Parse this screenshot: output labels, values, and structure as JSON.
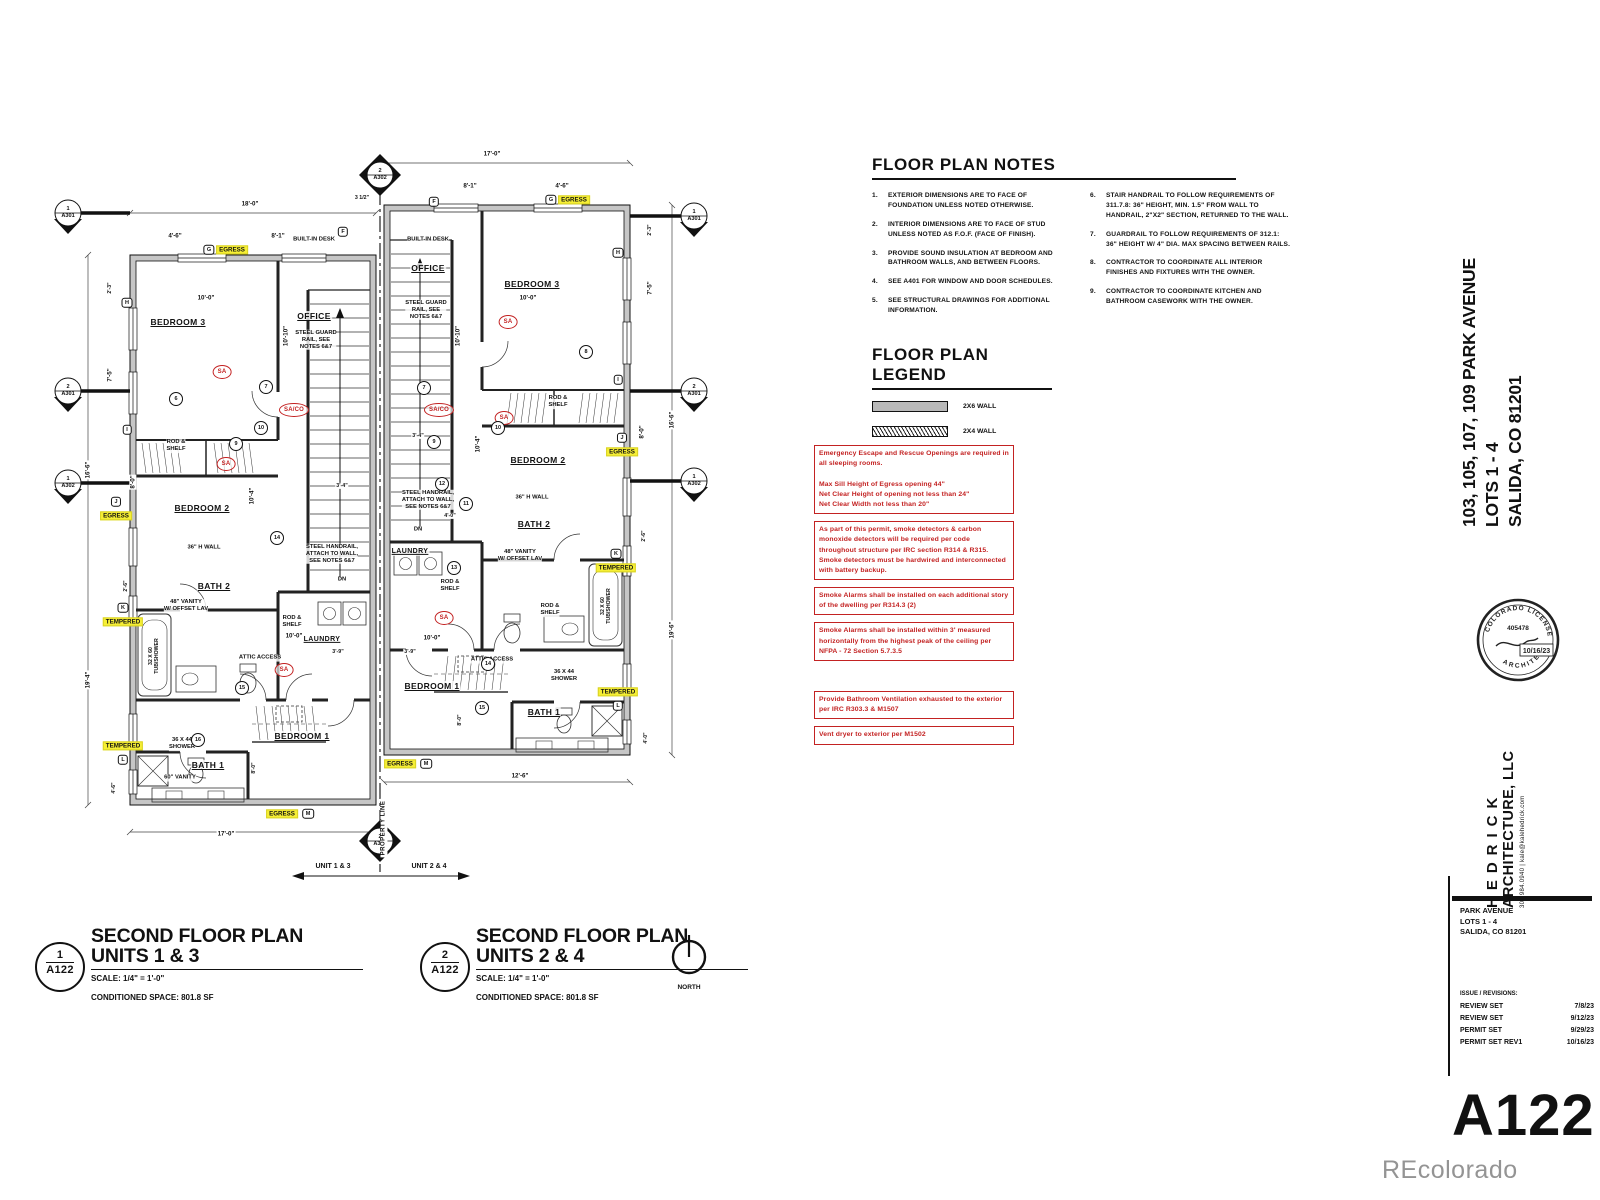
{
  "sheet": {
    "number": "A122",
    "watermark": "REcolorado"
  },
  "plan_notes": {
    "title": "FLOOR PLAN NOTES",
    "col1": [
      {
        "n": "1.",
        "t": "EXTERIOR DIMENSIONS ARE TO FACE OF FOUNDATION UNLESS NOTED OTHERWISE."
      },
      {
        "n": "2.",
        "t": "INTERIOR DIMENSIONS ARE TO FACE OF STUD UNLESS NOTED AS F.O.F. (FACE OF FINISH)."
      },
      {
        "n": "3.",
        "t": "PROVIDE SOUND INSULATION AT BEDROOM AND BATHROOM WALLS, AND BETWEEN FLOORS."
      },
      {
        "n": "4.",
        "t": "SEE A401 FOR WINDOW AND DOOR SCHEDULES."
      },
      {
        "n": "5.",
        "t": "SEE STRUCTURAL DRAWINGS FOR ADDITIONAL INFORMATION."
      }
    ],
    "col2": [
      {
        "n": "6.",
        "t": "STAIR HANDRAIL TO FOLLOW REQUIREMENTS OF 311.7.8: 36\" HEIGHT, MIN. 1.5\" FROM WALL TO HANDRAIL, 2\"X2\" SECTION, RETURNED TO THE WALL."
      },
      {
        "n": "7.",
        "t": "GUARDRAIL TO FOLLOW REQUIREMENTS OF 312.1: 36\" HEIGHT W/ 4\" DIA. MAX SPACING BETWEEN RAILS."
      },
      {
        "n": "8.",
        "t": "CONTRACTOR TO COORDINATE ALL INTERIOR FINISHES AND FIXTURES WITH THE OWNER."
      },
      {
        "n": "9.",
        "t": "CONTRACTOR TO COORDINATE KITCHEN AND BATHROOM CASEWORK WITH THE OWNER."
      }
    ]
  },
  "legend": {
    "title": "FLOOR PLAN LEGEND",
    "items": [
      {
        "label": "2X6  WALL",
        "style": "solid"
      },
      {
        "label": "2X4  WALL",
        "style": "hatched"
      }
    ]
  },
  "code_notes": [
    {
      "text": "Emergency Escape and Rescue Openings are required in all sleeping rooms.\n\nMax Sill Height of Egress opening 44\"\nNet Clear Height of opening not less than 24\"\nNet Clear Width not less than 20\""
    },
    {
      "text": "As part of this permit, smoke detectors & carbon monoxide detectors will be required per code throughout structure per IRC section R314 & R315. Smoke detectors must be hardwired and interconnected with battery backup."
    },
    {
      "text": "Smoke Alarms shall be installed on each additional story of the dwelling per R314.3 (2)"
    },
    {
      "text": "Smoke Alarms shall be installed within 3' measured horizontally from the highest peak of the ceiling per NFPA - 72 Section 5.7.3.5"
    },
    {
      "text": "Provide Bathroom Ventilation exhausted to the exterior per IRC R303.3 & M1507",
      "gap": true
    },
    {
      "text": "Vent dryer to exterior per M1502"
    }
  ],
  "plan_titles": [
    {
      "num": "1",
      "sheet": "A122",
      "line1": "SECOND FLOOR PLAN",
      "line2": "UNITS 1 & 3",
      "scale": "SCALE:  1/4\" = 1'-0\"",
      "space": "CONDITIONED SPACE:  801.8 SF"
    },
    {
      "num": "2",
      "sheet": "A122",
      "line1": "SECOND FLOOR PLAN",
      "line2": "UNITS 2 & 4",
      "scale": "SCALE:  1/4\" = 1'-0\"",
      "space": "CONDITIONED SPACE:  801.8 SF"
    }
  ],
  "north": {
    "label": "NORTH"
  },
  "titleblock": {
    "project_rot": [
      "103, 105, 107, 109 PARK AVENUE",
      "LOTS 1 - 4",
      "SALIDA, CO 81201"
    ],
    "firm_name1": "HEDRICK",
    "firm_name2": "ARCHITECTURE, LLC",
    "firm_contact": "303.984.0940   |   kale@kalehedrick.com",
    "stamp": {
      "arc_top": "COLORADO LICENSED",
      "arc_bottom": "ARCHITECT",
      "number": "405478",
      "date": "10/16/23"
    },
    "project_block": [
      "PARK AVENUE",
      "LOTS 1 - 4",
      "SALIDA, CO 81201"
    ],
    "issues_title": "ISSUE / REVISIONS:",
    "issues": [
      {
        "name": "REVIEW SET",
        "date": "7/8/23"
      },
      {
        "name": "REVIEW SET",
        "date": "9/12/23"
      },
      {
        "name": "PERMIT SET",
        "date": "9/29/23"
      },
      {
        "name": "PERMIT SET REV1",
        "date": "10/16/23"
      }
    ]
  },
  "plan_labels": [
    {
      "x": 148,
      "y": 182,
      "type": "room",
      "text": "BEDROOM 3"
    },
    {
      "x": 284,
      "y": 176,
      "type": "room",
      "text": "OFFICE"
    },
    {
      "x": 172,
      "y": 368,
      "type": "room",
      "text": "BEDROOM 2"
    },
    {
      "x": 184,
      "y": 446,
      "type": "room",
      "text": "BATH 2"
    },
    {
      "x": 292,
      "y": 500,
      "type": "room sm",
      "text": "LAUNDRY"
    },
    {
      "x": 272,
      "y": 596,
      "type": "room",
      "text": "BEDROOM 1"
    },
    {
      "x": 178,
      "y": 625,
      "type": "room",
      "text": "BATH 1"
    },
    {
      "x": 284,
      "y": 100,
      "type": "note",
      "text": "BUILT-IN DESK"
    },
    {
      "x": 286,
      "y": 200,
      "type": "note",
      "text": "STEEL GUARD\nRAIL, SEE\nNOTES 6&7"
    },
    {
      "x": 302,
      "y": 414,
      "type": "note",
      "text": "STEEL HANDRAIL,\nATTACH TO WALL,\nSEE NOTES 6&7"
    },
    {
      "x": 146,
      "y": 306,
      "type": "note",
      "text": "ROD &\nSHELF"
    },
    {
      "x": 262,
      "y": 482,
      "type": "note",
      "text": "ROD &\nSHELF"
    },
    {
      "x": 230,
      "y": 518,
      "type": "note",
      "text": "ATTIC ACCESS"
    },
    {
      "x": 174,
      "y": 408,
      "type": "note",
      "text": "36\" H WALL"
    },
    {
      "x": 156,
      "y": 466,
      "type": "note",
      "text": "48\" VANITY\nW/ OFFSET LAV"
    },
    {
      "x": 124,
      "y": 516,
      "type": "dimv sm",
      "text": "32 X 60\nTUB/SHOWER"
    },
    {
      "x": 152,
      "y": 604,
      "type": "note",
      "text": "36 X 44\nSHOWER"
    },
    {
      "x": 150,
      "y": 638,
      "type": "note",
      "text": "60\" VANITY"
    },
    {
      "x": 312,
      "y": 440,
      "type": "note",
      "text": "DN"
    },
    {
      "x": 202,
      "y": 110,
      "type": "hl",
      "text": "EGRESS"
    },
    {
      "x": 179,
      "y": 110,
      "type": "wtag",
      "text": "G"
    },
    {
      "x": 313,
      "y": 92,
      "type": "wtag",
      "text": "F"
    },
    {
      "x": 97,
      "y": 163,
      "type": "wtag",
      "text": "H"
    },
    {
      "x": 97,
      "y": 290,
      "type": "wtag",
      "text": "I"
    },
    {
      "x": 86,
      "y": 376,
      "type": "hl",
      "text": "EGRESS"
    },
    {
      "x": 86,
      "y": 362,
      "type": "wtag",
      "text": "J"
    },
    {
      "x": 93,
      "y": 482,
      "type": "hl",
      "text": "TEMPERED"
    },
    {
      "x": 93,
      "y": 468,
      "type": "wtag",
      "text": "K"
    },
    {
      "x": 93,
      "y": 606,
      "type": "hl",
      "text": "TEMPERED"
    },
    {
      "x": 93,
      "y": 620,
      "type": "wtag",
      "text": "L"
    },
    {
      "x": 252,
      "y": 674,
      "type": "hl",
      "text": "EGRESS"
    },
    {
      "x": 278,
      "y": 674,
      "type": "wtag",
      "text": "M"
    },
    {
      "x": 192,
      "y": 232,
      "type": "sa",
      "text": "SA"
    },
    {
      "x": 196,
      "y": 324,
      "type": "sa",
      "text": "SA"
    },
    {
      "x": 264,
      "y": 270,
      "type": "sa",
      "text": "SA/CO"
    },
    {
      "x": 254,
      "y": 530,
      "type": "sa",
      "text": "SA"
    },
    {
      "x": 220,
      "y": 64,
      "type": "dim",
      "text": "18'-0\""
    },
    {
      "x": 145,
      "y": 96,
      "type": "dim",
      "text": "4'-6\""
    },
    {
      "x": 248,
      "y": 96,
      "type": "dim",
      "text": "8'-1\""
    },
    {
      "x": 332,
      "y": 58,
      "type": "dim sm",
      "text": "3 1/2\""
    },
    {
      "x": 58,
      "y": 330,
      "type": "dimv",
      "text": "16'-6\""
    },
    {
      "x": 80,
      "y": 148,
      "type": "dimv sm",
      "text": "2'-3\""
    },
    {
      "x": 80,
      "y": 235,
      "type": "dimv",
      "text": "7'-5\""
    },
    {
      "x": 103,
      "y": 342,
      "type": "dimv",
      "text": "8'-0\""
    },
    {
      "x": 58,
      "y": 540,
      "type": "dimv",
      "text": "19'-4\""
    },
    {
      "x": 96,
      "y": 446,
      "type": "dimv sm",
      "text": "2'-6\""
    },
    {
      "x": 84,
      "y": 648,
      "type": "dimv sm",
      "text": "4'-6\""
    },
    {
      "x": 196,
      "y": 694,
      "type": "dim",
      "text": "17'-0\""
    },
    {
      "x": 176,
      "y": 158,
      "type": "dim",
      "text": "10'-0\""
    },
    {
      "x": 256,
      "y": 196,
      "type": "dimv",
      "text": "10'-10\""
    },
    {
      "x": 222,
      "y": 356,
      "type": "dimv",
      "text": "10'-4\""
    },
    {
      "x": 264,
      "y": 496,
      "type": "dim",
      "text": "10'-0\""
    },
    {
      "x": 308,
      "y": 512,
      "type": "dim sm",
      "text": "3'-9\""
    },
    {
      "x": 312,
      "y": 346,
      "type": "dim sm",
      "text": "3'-4\""
    },
    {
      "x": 224,
      "y": 628,
      "type": "dimv sm",
      "text": "8'-0\""
    },
    {
      "x": 146,
      "y": 259,
      "type": "dtag",
      "text": "6"
    },
    {
      "x": 236,
      "y": 247,
      "type": "dtag",
      "text": "7"
    },
    {
      "x": 206,
      "y": 304,
      "type": "dtag",
      "text": "9"
    },
    {
      "x": 231,
      "y": 288,
      "type": "dtag",
      "text": "10"
    },
    {
      "x": 247,
      "y": 398,
      "type": "dtag",
      "text": "14"
    },
    {
      "x": 212,
      "y": 548,
      "type": "dtag",
      "text": "15"
    },
    {
      "x": 168,
      "y": 600,
      "type": "dtag",
      "text": "16"
    },
    {
      "x": 398,
      "y": 128,
      "type": "room",
      "text": "OFFICE"
    },
    {
      "x": 502,
      "y": 144,
      "type": "room",
      "text": "BEDROOM 3"
    },
    {
      "x": 508,
      "y": 320,
      "type": "room",
      "text": "BEDROOM 2"
    },
    {
      "x": 504,
      "y": 384,
      "type": "room",
      "text": "BATH 2"
    },
    {
      "x": 380,
      "y": 412,
      "type": "room sm",
      "text": "LAUNDRY"
    },
    {
      "x": 402,
      "y": 546,
      "type": "room",
      "text": "BEDROOM 1"
    },
    {
      "x": 514,
      "y": 572,
      "type": "room",
      "text": "BATH 1"
    },
    {
      "x": 398,
      "y": 100,
      "type": "note",
      "text": "BUILT-IN DESK"
    },
    {
      "x": 396,
      "y": 170,
      "type": "note",
      "text": "STEEL GUARD\nRAIL, SEE\nNOTES 6&7"
    },
    {
      "x": 398,
      "y": 360,
      "type": "note",
      "text": "STEEL HANDRAIL,\nATTACH TO WALL,\nSEE NOTES 6&7"
    },
    {
      "x": 528,
      "y": 262,
      "type": "note",
      "text": "ROD &\nSHELF"
    },
    {
      "x": 420,
      "y": 446,
      "type": "note",
      "text": "ROD &\nSHELF"
    },
    {
      "x": 520,
      "y": 470,
      "type": "note",
      "text": "ROD &\nSHELF"
    },
    {
      "x": 462,
      "y": 520,
      "type": "note",
      "text": "ATTIC ACCESS"
    },
    {
      "x": 502,
      "y": 358,
      "type": "note",
      "text": "36\" H WALL"
    },
    {
      "x": 490,
      "y": 416,
      "type": "note",
      "text": "48\" VANITY\nW/ OFFSET LAV"
    },
    {
      "x": 576,
      "y": 466,
      "type": "dimv sm",
      "text": "32 X 60\nTUB/SHOWER"
    },
    {
      "x": 534,
      "y": 536,
      "type": "note",
      "text": "36 X 44\nSHOWER"
    },
    {
      "x": 388,
      "y": 390,
      "type": "note",
      "text": "DN"
    },
    {
      "x": 544,
      "y": 60,
      "type": "hl",
      "text": "EGRESS"
    },
    {
      "x": 521,
      "y": 60,
      "type": "wtag",
      "text": "G"
    },
    {
      "x": 404,
      "y": 62,
      "type": "wtag",
      "text": "F"
    },
    {
      "x": 588,
      "y": 113,
      "type": "wtag",
      "text": "H"
    },
    {
      "x": 588,
      "y": 240,
      "type": "wtag",
      "text": "I"
    },
    {
      "x": 592,
      "y": 312,
      "type": "hl",
      "text": "EGRESS"
    },
    {
      "x": 592,
      "y": 298,
      "type": "wtag",
      "text": "J"
    },
    {
      "x": 586,
      "y": 428,
      "type": "hl",
      "text": "TEMPERED"
    },
    {
      "x": 586,
      "y": 414,
      "type": "wtag",
      "text": "K"
    },
    {
      "x": 588,
      "y": 552,
      "type": "hl",
      "text": "TEMPERED"
    },
    {
      "x": 588,
      "y": 566,
      "type": "wtag",
      "text": "L"
    },
    {
      "x": 370,
      "y": 624,
      "type": "hl",
      "text": "EGRESS"
    },
    {
      "x": 396,
      "y": 624,
      "type": "wtag",
      "text": "M"
    },
    {
      "x": 478,
      "y": 182,
      "type": "sa",
      "text": "SA"
    },
    {
      "x": 409,
      "y": 270,
      "type": "sa",
      "text": "SA/CO"
    },
    {
      "x": 474,
      "y": 278,
      "type": "sa",
      "text": "SA"
    },
    {
      "x": 414,
      "y": 478,
      "type": "sa",
      "text": "SA"
    },
    {
      "x": 462,
      "y": 14,
      "type": "dim",
      "text": "17'-0\""
    },
    {
      "x": 440,
      "y": 46,
      "type": "dim",
      "text": "8'-1\""
    },
    {
      "x": 532,
      "y": 46,
      "type": "dim",
      "text": "4'-6\""
    },
    {
      "x": 498,
      "y": 158,
      "type": "dim",
      "text": "10'-0\""
    },
    {
      "x": 428,
      "y": 196,
      "type": "dimv",
      "text": "10'-10\""
    },
    {
      "x": 642,
      "y": 280,
      "type": "dimv",
      "text": "16'-6\""
    },
    {
      "x": 620,
      "y": 148,
      "type": "dimv",
      "text": "7'-5\""
    },
    {
      "x": 620,
      "y": 90,
      "type": "dimv sm",
      "text": "2'-3\""
    },
    {
      "x": 612,
      "y": 292,
      "type": "dimv",
      "text": "8'-0\""
    },
    {
      "x": 642,
      "y": 490,
      "type": "dimv",
      "text": "19'-6\""
    },
    {
      "x": 614,
      "y": 396,
      "type": "dimv sm",
      "text": "2'-6\""
    },
    {
      "x": 616,
      "y": 598,
      "type": "dimv sm",
      "text": "4'-0\""
    },
    {
      "x": 490,
      "y": 636,
      "type": "dim",
      "text": "12'-6\""
    },
    {
      "x": 402,
      "y": 498,
      "type": "dim",
      "text": "10'-0\""
    },
    {
      "x": 380,
      "y": 512,
      "type": "dim sm",
      "text": "3'-9\""
    },
    {
      "x": 388,
      "y": 296,
      "type": "dim sm",
      "text": "3'-4\""
    },
    {
      "x": 448,
      "y": 304,
      "type": "dimv",
      "text": "10'-4\""
    },
    {
      "x": 430,
      "y": 580,
      "type": "dimv sm",
      "text": "8'-0\""
    },
    {
      "x": 420,
      "y": 376,
      "type": "dim sm",
      "text": "4'-0\""
    },
    {
      "x": 556,
      "y": 212,
      "type": "dtag",
      "text": "8"
    },
    {
      "x": 394,
      "y": 248,
      "type": "dtag",
      "text": "7"
    },
    {
      "x": 468,
      "y": 288,
      "type": "dtag",
      "text": "10"
    },
    {
      "x": 404,
      "y": 302,
      "type": "dtag",
      "text": "9"
    },
    {
      "x": 436,
      "y": 364,
      "type": "dtag",
      "text": "11"
    },
    {
      "x": 412,
      "y": 344,
      "type": "dtag",
      "text": "12"
    },
    {
      "x": 424,
      "y": 428,
      "type": "dtag",
      "text": "13"
    },
    {
      "x": 458,
      "y": 524,
      "type": "dtag",
      "text": "14"
    },
    {
      "x": 452,
      "y": 568,
      "type": "dtag",
      "text": "15"
    },
    {
      "x": 38,
      "y": 73,
      "type": "stag",
      "text": "1\nA301"
    },
    {
      "x": 38,
      "y": 251,
      "type": "stag",
      "text": "2\nA301"
    },
    {
      "x": 38,
      "y": 343,
      "type": "stag",
      "text": "1\nA302"
    },
    {
      "x": 664,
      "y": 76,
      "type": "stag",
      "text": "1\nA301"
    },
    {
      "x": 664,
      "y": 251,
      "type": "stag",
      "text": "2\nA301"
    },
    {
      "x": 664,
      "y": 341,
      "type": "stag",
      "text": "1\nA302"
    },
    {
      "x": 350,
      "y": 35,
      "type": "stag",
      "text": "2\nA302"
    },
    {
      "x": 350,
      "y": 701,
      "type": "stag",
      "text": "2\nA302"
    },
    {
      "x": 303,
      "y": 727,
      "type": "ulabel",
      "text": "UNIT 1 & 3"
    },
    {
      "x": 399,
      "y": 727,
      "type": "ulabel",
      "text": "UNIT 2 & 4"
    },
    {
      "x": 354,
      "y": 688,
      "type": "plabel",
      "text": "PROPERTY LINE"
    }
  ]
}
